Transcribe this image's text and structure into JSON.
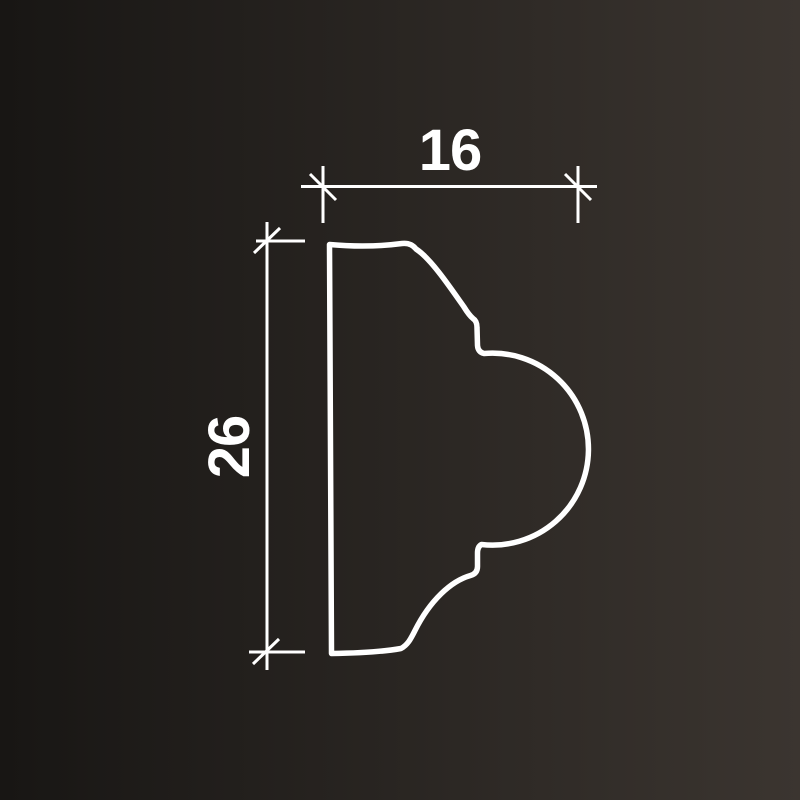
{
  "drawing": {
    "kind": "molding-profile-cross-section",
    "line_color": "#ffffff",
    "background": {
      "gradient_start": "#181614",
      "gradient_end": "#3b3530"
    },
    "dimensions": {
      "width_label": "16",
      "height_label": "26"
    }
  }
}
